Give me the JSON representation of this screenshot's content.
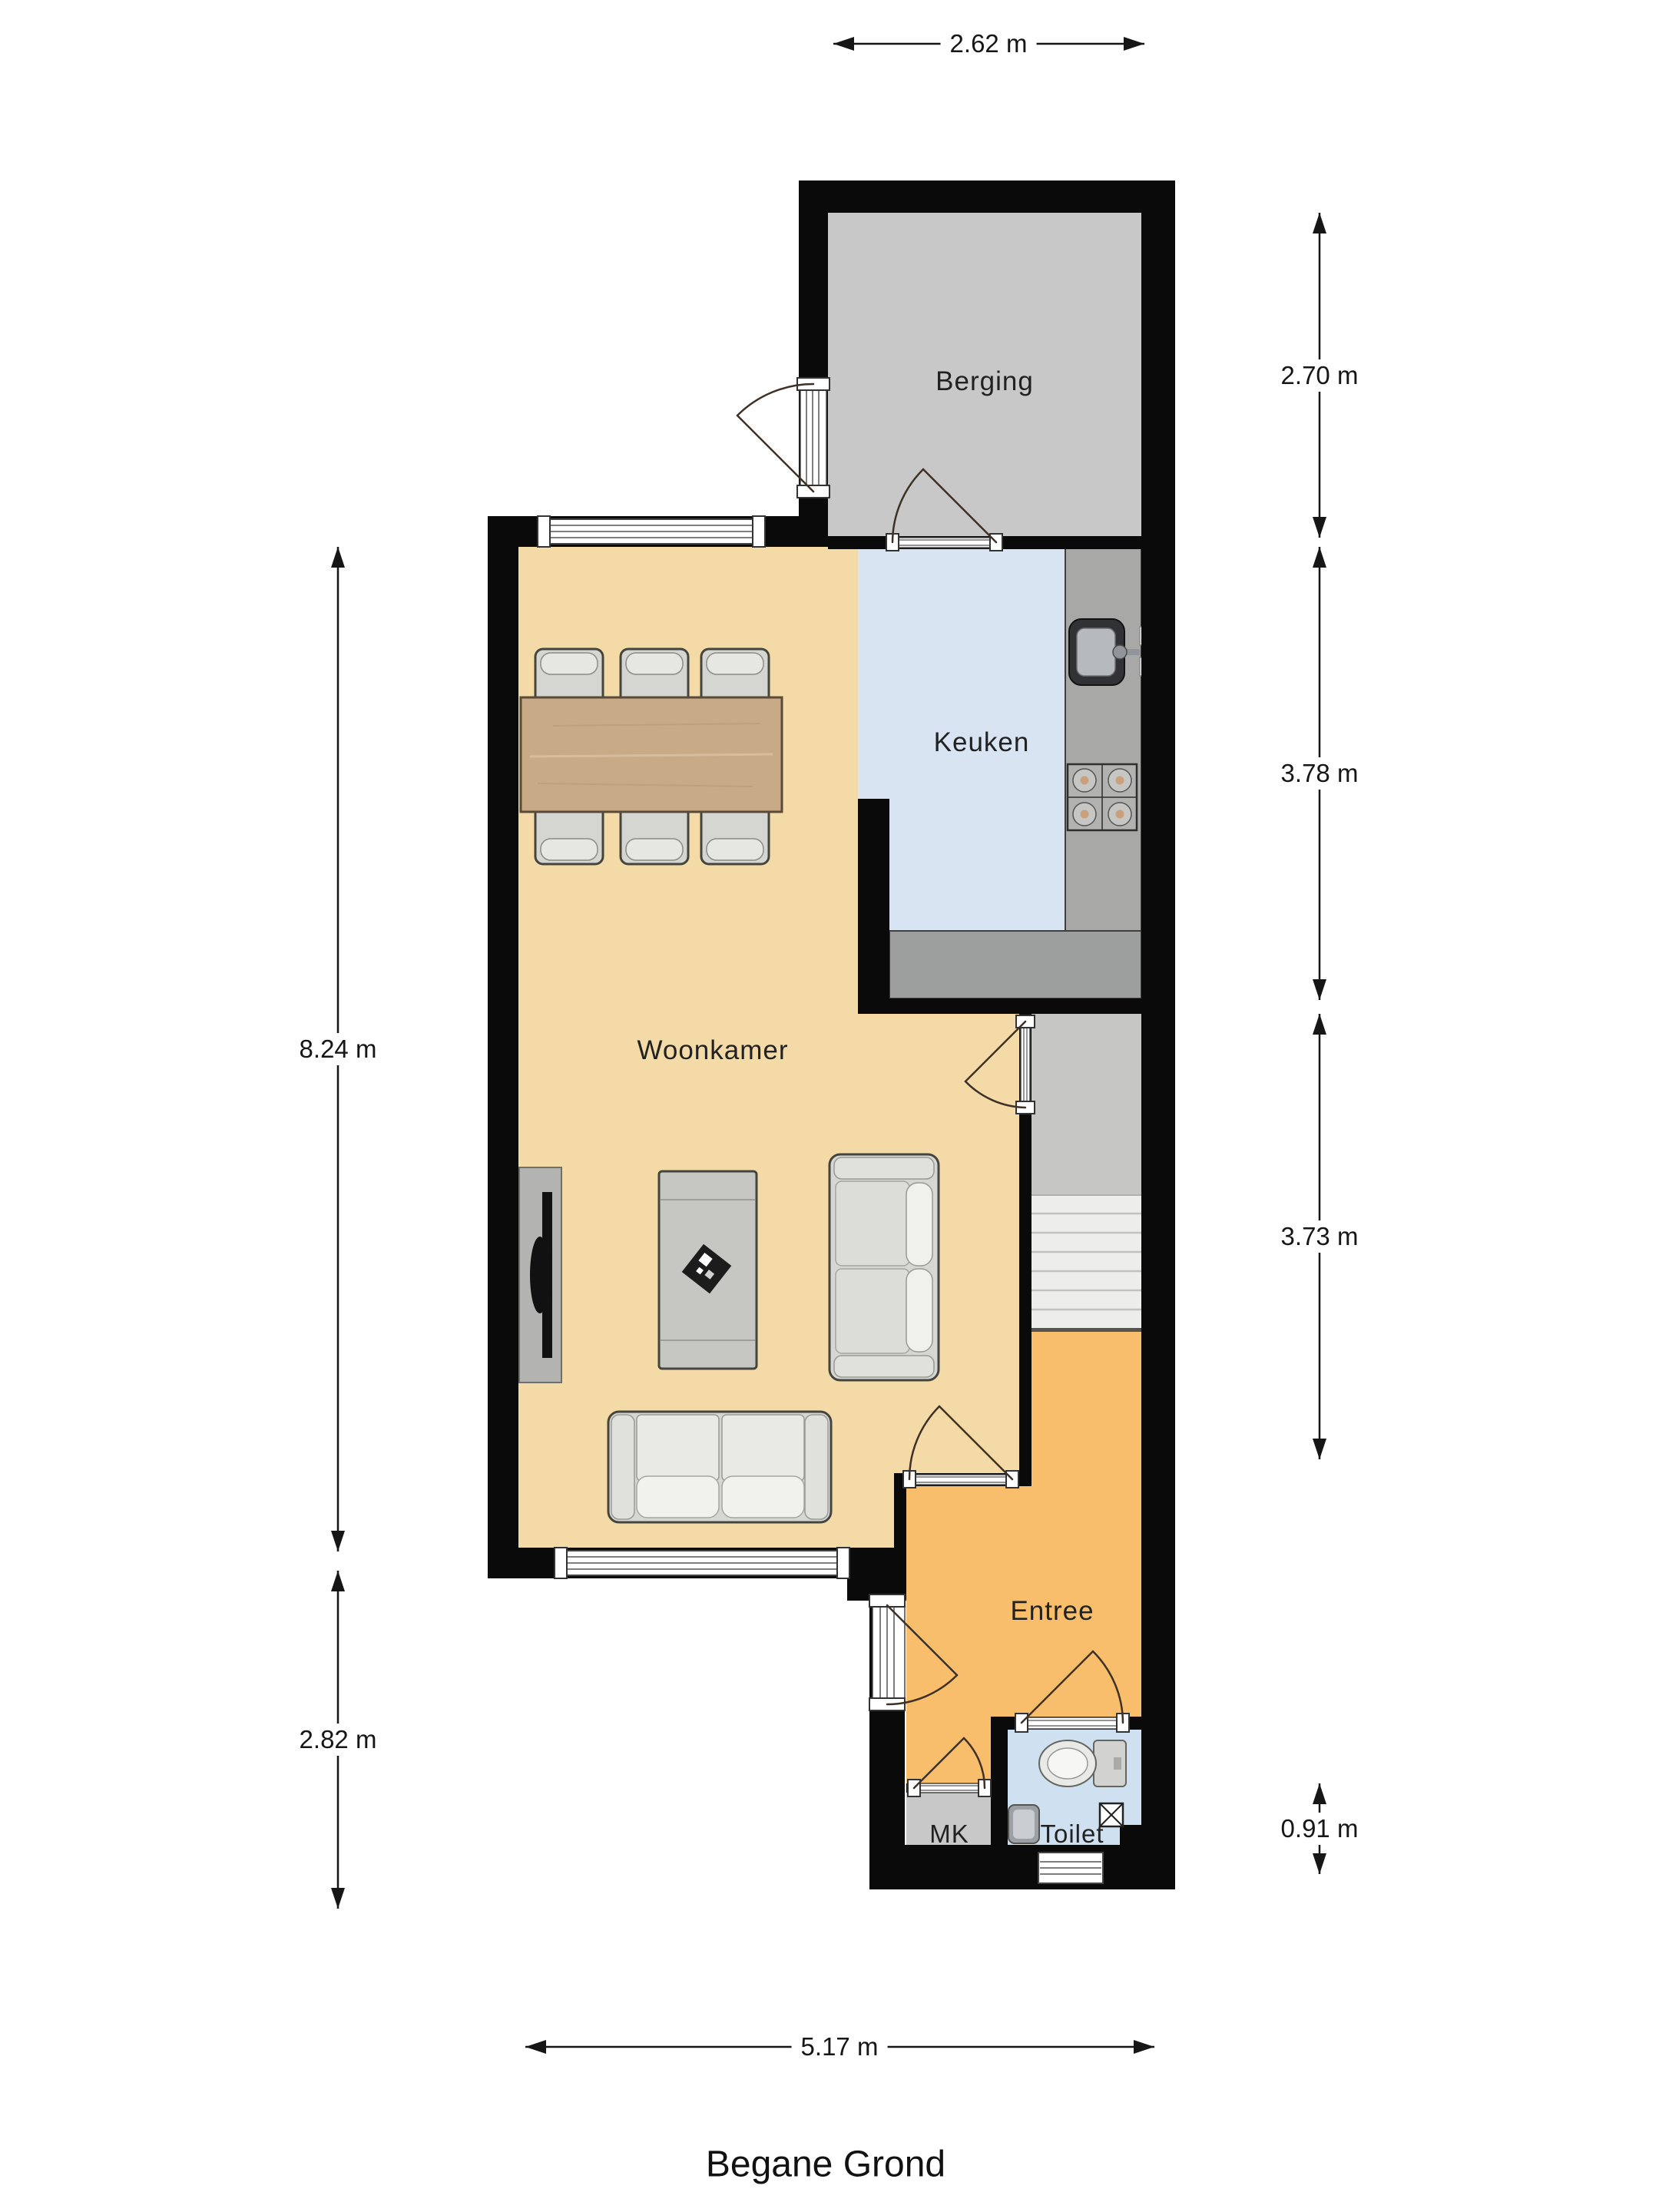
{
  "title": "Begane Grond",
  "rooms": [
    {
      "name": "berging",
      "label": "Berging"
    },
    {
      "name": "keuken",
      "label": "Keuken"
    },
    {
      "name": "woonkamer",
      "label": "Woonkamer"
    },
    {
      "name": "entree",
      "label": "Entree"
    },
    {
      "name": "mk",
      "label": "MK"
    },
    {
      "name": "toilet",
      "label": "Toilet"
    }
  ],
  "dimensions": {
    "top": "2.62 m",
    "right": [
      "2.70 m",
      "3.78 m",
      "3.73 m",
      "0.91 m"
    ],
    "left": [
      "8.24 m",
      "2.82 m"
    ],
    "bottom": "5.17 m"
  },
  "colors": {
    "wall": "#0a0a0a",
    "woonkamer_floor": "#f4daa7",
    "keuken_floor": "#d8e4f2",
    "berging_floor": "#c8c8c8",
    "hall_floor": "#c6c6c4",
    "entree_floor": "#f8be6c",
    "mk_floor": "#c8c8c8",
    "toilet_floor": "#cfe0f0",
    "counter": "#a8a8a6",
    "stairs": "#ededeb",
    "table_wood": "#c9aa87",
    "furniture": "#d6d6d3"
  }
}
